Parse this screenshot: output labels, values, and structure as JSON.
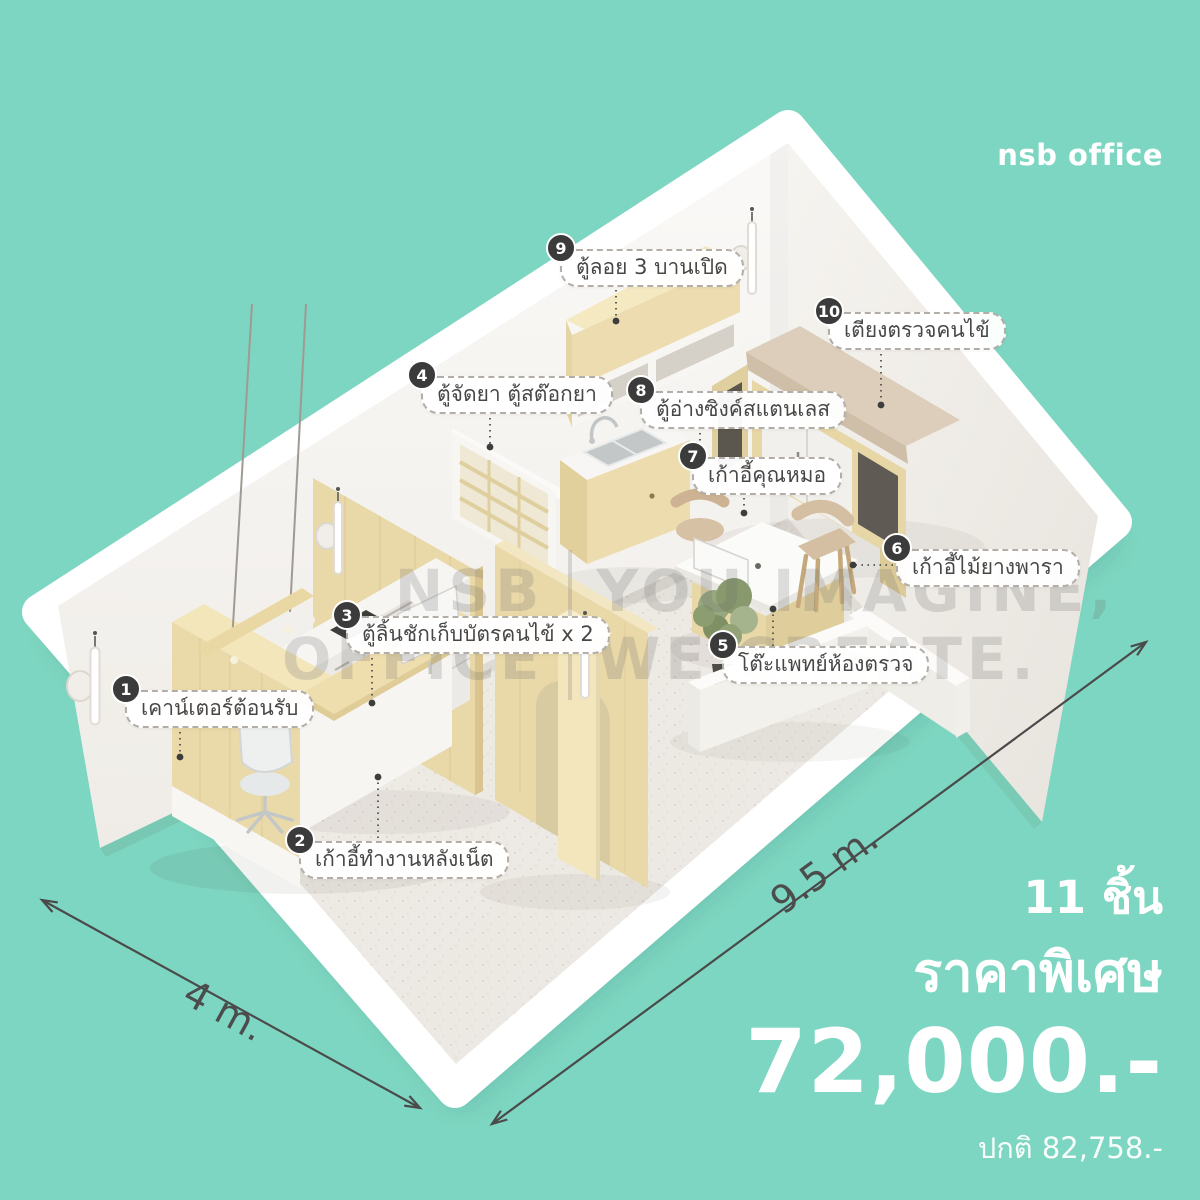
{
  "brand": {
    "logo": "nsb office"
  },
  "scene": {
    "watermark": {
      "l1a": "NSB",
      "l2a": "OFFICE",
      "l1b": "YOU IMAGINE,",
      "l2b": "WE CREATE."
    },
    "dimensions": {
      "width": "4 m.",
      "length": "9.5 m."
    }
  },
  "callouts": [
    {
      "num": "1",
      "text": "เคาน์เตอร์ต้อนรับ"
    },
    {
      "num": "2",
      "text": "เก้าอี้ทำงานหลังเน็ต"
    },
    {
      "num": "3",
      "text": "ตู้ลิ้นชักเก็บบัตรคนไข้ x 2"
    },
    {
      "num": "4",
      "text": "ตู้จัดยา ตู้สต๊อกยา"
    },
    {
      "num": "5",
      "text": "โต๊ะแพทย์ห้องตรวจ"
    },
    {
      "num": "6",
      "text": "เก้าอี้ไม้ยางพารา"
    },
    {
      "num": "7",
      "text": "เก้าอี้คุณหมอ"
    },
    {
      "num": "8",
      "text": "ตู้อ่างซิงค์สแตนเลส"
    },
    {
      "num": "9",
      "text": "ตู้ลอย 3 บานเปิด"
    },
    {
      "num": "10",
      "text": "เตียงตรวจคนไข้"
    }
  ],
  "pricing": {
    "items_count": "11 ชิ้น",
    "special_label": "ราคาพิเศษ",
    "special_price": "72,000.-",
    "normal_price": "ปกติ 82,758.-"
  },
  "colors": {
    "background": "#7dd6c1",
    "badge": "#3b3b3b",
    "wood": "#ead9a9",
    "wall": "#f6f4f1",
    "floor": "#efece7"
  }
}
